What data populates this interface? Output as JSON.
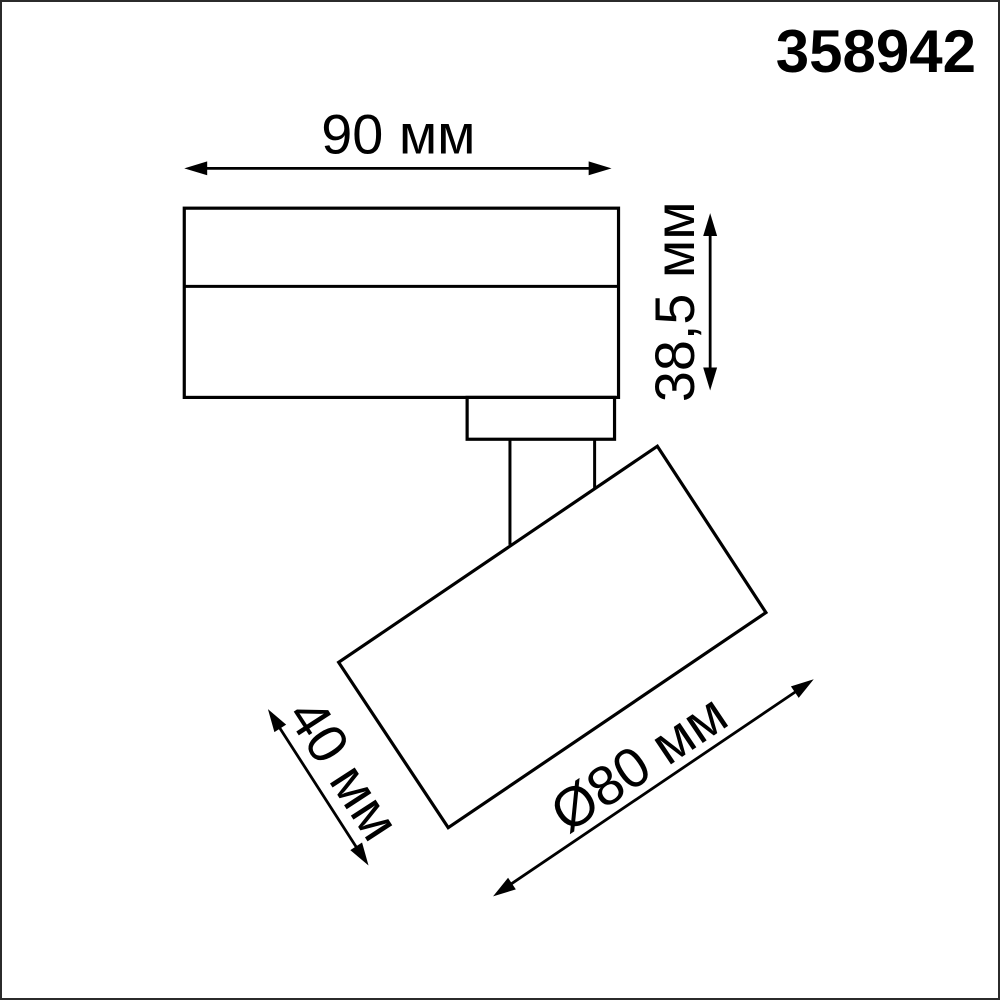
{
  "article_number": "358942",
  "drawing": {
    "type": "technical-dimension-drawing",
    "subject": "track-mounted spotlight, side view"
  },
  "dimensions": {
    "body_width": {
      "label": "90 мм",
      "value_mm": 90
    },
    "body_height": {
      "label": "38,5 мм",
      "value_mm": 38.5
    },
    "head_length": {
      "label": "40 мм",
      "value_mm": 40
    },
    "head_diameter": {
      "label": "Ø80 мм",
      "value_mm": 80
    }
  },
  "colors": {
    "ink": "#000000",
    "background": "#ffffff",
    "frame": "#2b2b2b"
  }
}
